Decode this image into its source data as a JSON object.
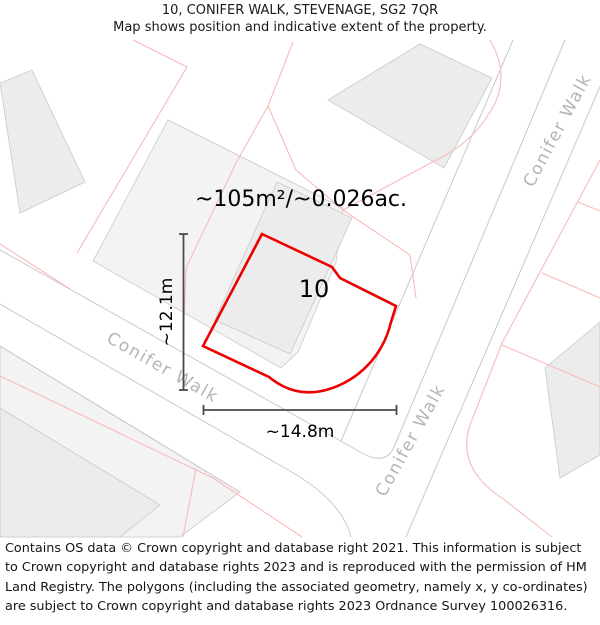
{
  "header": {
    "title": "10, CONIFER WALK, STEVENAGE, SG2 7QR",
    "subtitle": "Map shows position and indicative extent of the property."
  },
  "map": {
    "road_name": "Conifer Walk",
    "plot_number": "10",
    "area_label": "~105m²/~0.026ac.",
    "width_label": "~14.8m",
    "height_label": "~12.1m",
    "colors": {
      "property_outline": "#ee0000",
      "parcel_line_pink": "#f6bcba",
      "map_line_gray": "#c9c9c9",
      "road_label_gray": "#b5b5b5",
      "dimension_line": "#4a4a4a",
      "building_fill": "#ececec",
      "parcel_fill": "#f3f3f3"
    }
  },
  "footer": {
    "attribution": "Contains OS data © Crown copyright and database right 2021. This information is subject to Crown copyright and database rights 2023 and is reproduced with the permission of HM Land Registry. The polygons (including the associated geometry, namely x, y co-ordinates) are subject to Crown copyright and database rights 2023 Ordnance Survey 100026316."
  }
}
